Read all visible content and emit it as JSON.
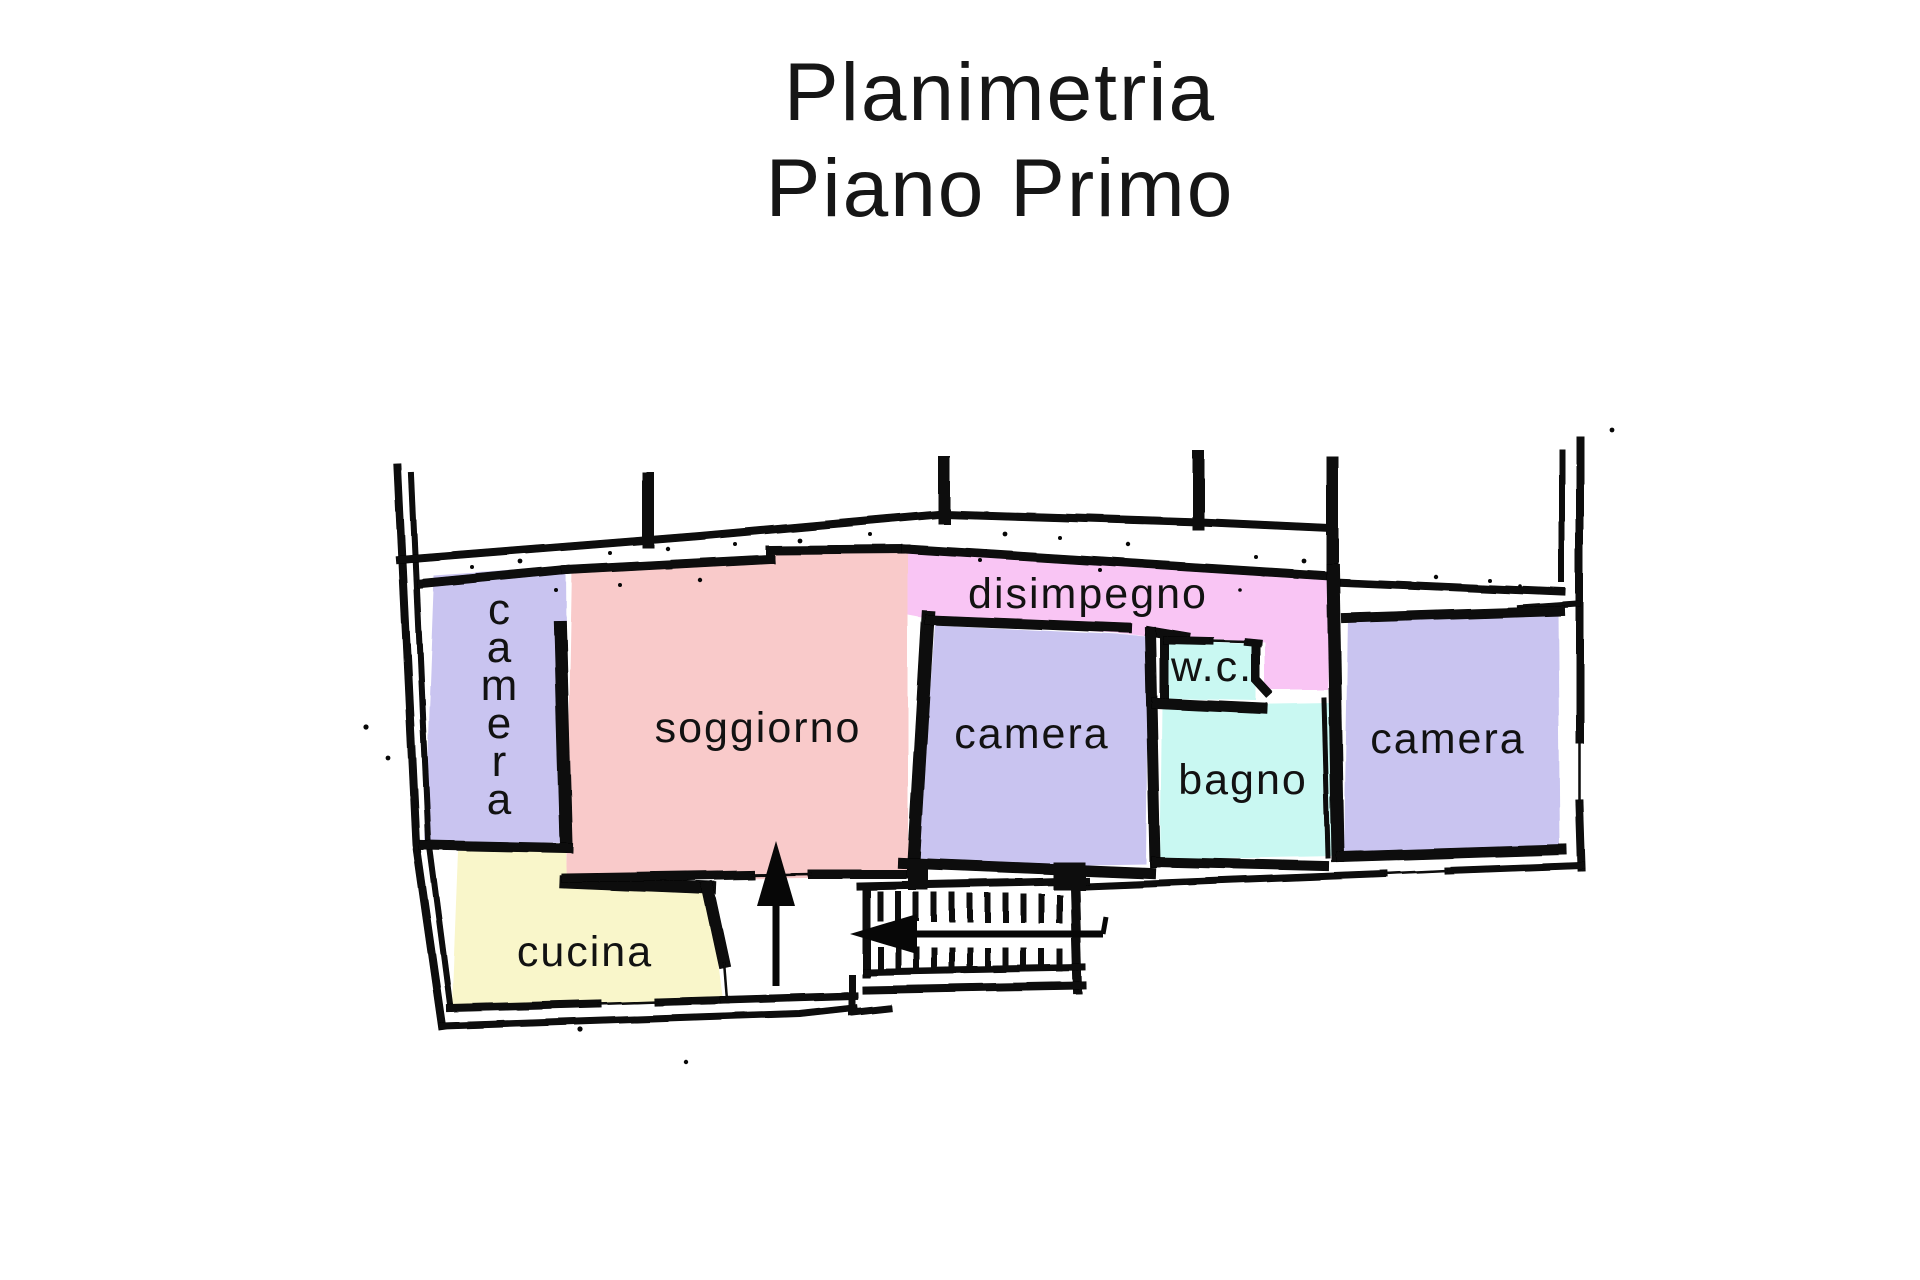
{
  "title": {
    "line1": "Planimetria",
    "line2": "Piano Primo"
  },
  "rooms": {
    "camera_left": {
      "label": "camera",
      "color": "#c9c4f0"
    },
    "soggiorno": {
      "label": "soggiorno",
      "color": "#f9caca"
    },
    "disimpegno": {
      "label": "disimpegno",
      "color": "#f9c5f4"
    },
    "camera_center": {
      "label": "camera",
      "color": "#c9c4f0"
    },
    "wc": {
      "label": "w.c.",
      "color": "#c9f8f2"
    },
    "bagno": {
      "label": "bagno",
      "color": "#c9f8f2"
    },
    "camera_right": {
      "label": "camera",
      "color": "#c9c4f0"
    },
    "cucina": {
      "label": "cucina",
      "color": "#f9f6ca"
    }
  },
  "palette": {
    "walls": "#070707",
    "text": "#161616",
    "background": "#ffffff"
  }
}
